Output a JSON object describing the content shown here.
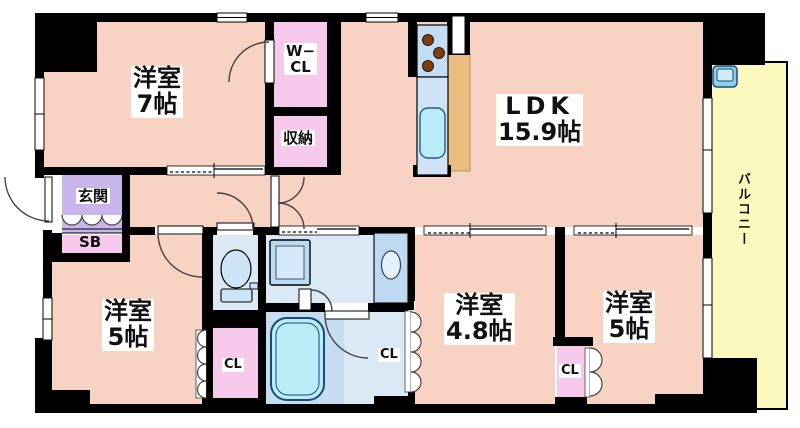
{
  "colors": {
    "room": "#f8d2c2",
    "closet": "#f6c9ed",
    "entrance": "#c9b5e9",
    "sanitary": "#dbe9f7",
    "bath_floor": "#c6dcf1",
    "tub": "#b7eef8",
    "balcony": "#fbf9be",
    "counter_tan": "#e9bd7f",
    "kitchen_counter": "#c3ddf4",
    "fixture_blue": "#cde4f7",
    "wall": "#000000"
  },
  "rooms": {
    "bed7": {
      "name": "洋室",
      "size": "7帖"
    },
    "ldk": {
      "name": "LDK",
      "size": "15.9帖"
    },
    "bed5_left": {
      "name": "洋室",
      "size": "5帖"
    },
    "bed48": {
      "name": "洋室",
      "size": "4.8帖"
    },
    "bed5_right": {
      "name": "洋室",
      "size": "5帖"
    },
    "entrance": {
      "label": "玄関"
    },
    "shoe_box": {
      "label": "SB"
    },
    "walk_in_closet": {
      "line1": "W−",
      "line2": "CL"
    },
    "storage": {
      "label": "収納"
    },
    "closet_left": {
      "label": "CL"
    },
    "closet_mid": {
      "label": "CL"
    },
    "closet_right": {
      "label": "CL"
    },
    "balcony": {
      "label": "バルコニー"
    }
  }
}
